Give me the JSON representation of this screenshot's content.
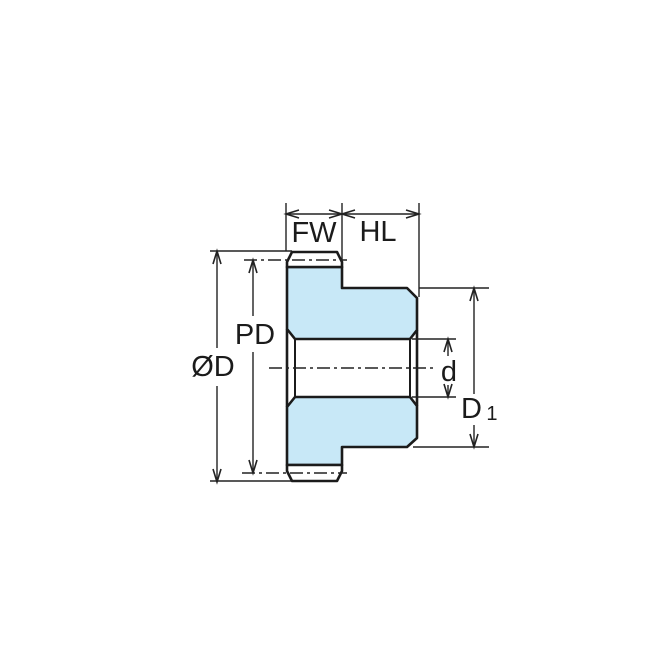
{
  "diagram": {
    "labels": {
      "face_width": "FW",
      "hub_length": "HL",
      "pitch_diameter": "PD",
      "outside_diameter": "ØD",
      "bore_diameter": "d",
      "hub_diameter_base": "D",
      "hub_diameter_subscript": "1"
    },
    "colors": {
      "part_fill": "#C8E8F7",
      "outline": "#1B1B1B",
      "dimension_line": "#222222",
      "background": "#FFFFFF"
    }
  }
}
